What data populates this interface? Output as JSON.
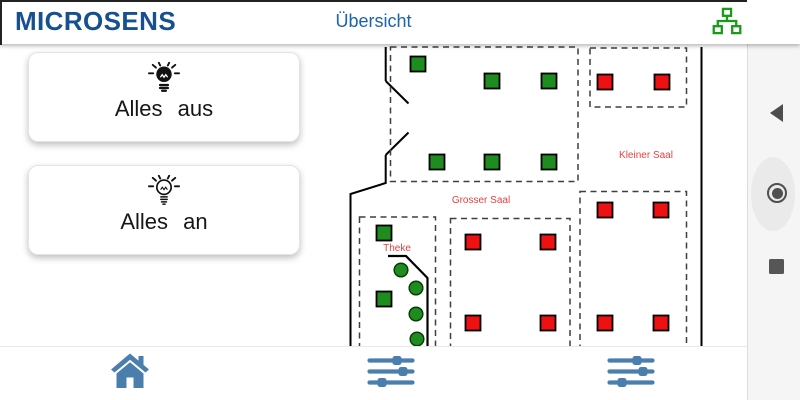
{
  "header": {
    "brand": "MICROSENS",
    "title": "Übersicht",
    "network_icon": "lan-topology"
  },
  "buttons": {
    "all_off": {
      "label": "Alles aus",
      "icon": "bulb-filled"
    },
    "all_on": {
      "label": "Alles an",
      "icon": "bulb-outline"
    }
  },
  "floorplan": {
    "labels": [
      {
        "text": "Grosser Saal",
        "x": 481,
        "y": 203
      },
      {
        "text": "Kleiner Saal",
        "x": 646,
        "y": 158
      },
      {
        "text": "Theke",
        "x": 397,
        "y": 251
      }
    ],
    "lights": [
      {
        "x": 418,
        "y": 64,
        "shape": "square",
        "state": "on"
      },
      {
        "x": 492,
        "y": 81,
        "shape": "square",
        "state": "on"
      },
      {
        "x": 549,
        "y": 81,
        "shape": "square",
        "state": "on"
      },
      {
        "x": 437,
        "y": 162,
        "shape": "square",
        "state": "on"
      },
      {
        "x": 492,
        "y": 162,
        "shape": "square",
        "state": "on"
      },
      {
        "x": 549,
        "y": 162,
        "shape": "square",
        "state": "on"
      },
      {
        "x": 384,
        "y": 233,
        "shape": "square",
        "state": "on"
      },
      {
        "x": 384,
        "y": 299,
        "shape": "square",
        "state": "on"
      },
      {
        "x": 401,
        "y": 270,
        "shape": "round",
        "state": "on"
      },
      {
        "x": 416,
        "y": 288,
        "shape": "round",
        "state": "on"
      },
      {
        "x": 416,
        "y": 314,
        "shape": "round",
        "state": "on"
      },
      {
        "x": 417,
        "y": 339,
        "shape": "round",
        "state": "on"
      },
      {
        "x": 605,
        "y": 82,
        "shape": "square",
        "state": "off"
      },
      {
        "x": 662,
        "y": 82,
        "shape": "square",
        "state": "off"
      },
      {
        "x": 605,
        "y": 210,
        "shape": "square",
        "state": "off"
      },
      {
        "x": 661,
        "y": 210,
        "shape": "square",
        "state": "off"
      },
      {
        "x": 605,
        "y": 323,
        "shape": "square",
        "state": "off"
      },
      {
        "x": 661,
        "y": 323,
        "shape": "square",
        "state": "off"
      },
      {
        "x": 473,
        "y": 242,
        "shape": "square",
        "state": "off"
      },
      {
        "x": 548,
        "y": 242,
        "shape": "square",
        "state": "off"
      },
      {
        "x": 473,
        "y": 323,
        "shape": "square",
        "state": "off"
      },
      {
        "x": 548,
        "y": 323,
        "shape": "square",
        "state": "off"
      }
    ]
  },
  "bottom_nav": [
    {
      "name": "home",
      "icon": "home-icon"
    },
    {
      "name": "controls-1",
      "icon": "tune-icon"
    },
    {
      "name": "controls-2",
      "icon": "tune-icon"
    }
  ],
  "android_nav": [
    {
      "name": "back",
      "icon": "triangle-left-icon"
    },
    {
      "name": "home",
      "icon": "circle-icon"
    },
    {
      "name": "recents",
      "icon": "square-icon"
    }
  ],
  "colors": {
    "brand_navy": "#17508f",
    "title_blue": "#1a64ad",
    "light_on_green": "#1e8c1e",
    "light_off_red": "#ee1111",
    "light_round_stroke": "#0b3d0b",
    "room_label_red": "#e84040",
    "nav_icon_blue": "#4a7fad",
    "lan_icon_green": "#1a9a1a",
    "android_icon_gray": "#4d4d4d"
  }
}
